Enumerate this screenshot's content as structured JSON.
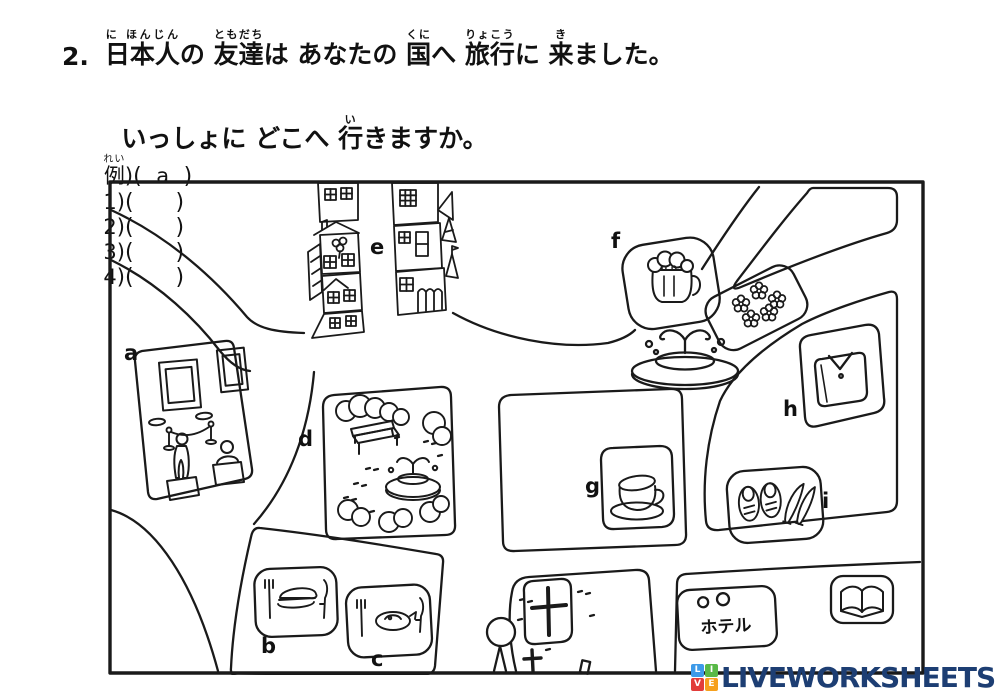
{
  "question": {
    "number": "2.",
    "line1": [
      {
        "b": "日本人",
        "r": "に ほんじん"
      },
      {
        "b": "の "
      },
      {
        "b": "友達",
        "r": "ともだち"
      },
      {
        "b": "は あなたの "
      },
      {
        "b": "国",
        "r": "くに"
      },
      {
        "b": "へ "
      },
      {
        "b": "旅行",
        "r": "りょこう"
      },
      {
        "b": "に "
      },
      {
        "b": "来",
        "r": "き"
      },
      {
        "b": "ました。"
      }
    ],
    "line2": [
      {
        "b": "いっしょに どこへ "
      },
      {
        "b": "行",
        "r": "い"
      },
      {
        "b": "きますか。"
      }
    ]
  },
  "answers": {
    "items": [
      {
        "label": "例",
        "label_ruby": "れい",
        "suffix": ")",
        "open": "(",
        "value": "a",
        "close": ")"
      },
      {
        "label": "1",
        "label_ruby": "",
        "suffix": ")",
        "open": "(",
        "value": "",
        "close": ")"
      },
      {
        "label": "2",
        "label_ruby": "",
        "suffix": ")",
        "open": "(",
        "value": "",
        "close": ")"
      },
      {
        "label": "3",
        "label_ruby": "",
        "suffix": ")",
        "open": "(",
        "value": "",
        "close": ")"
      },
      {
        "label": "4",
        "label_ruby": "",
        "suffix": ")",
        "open": "(",
        "value": "",
        "close": ")"
      }
    ]
  },
  "map": {
    "labels": {
      "a": "a",
      "b": "b",
      "c": "c",
      "d": "d",
      "e": "e",
      "f": "f",
      "g": "g",
      "h": "h",
      "i": "i"
    },
    "hotel_sign": "ホテル",
    "legend": {
      "a": "museum-gallery",
      "b": "restaurant-burger",
      "c": "restaurant-fish",
      "d": "park",
      "e": "town-street",
      "f": "beer-pub",
      "g": "cafe",
      "h": "clothes-shop",
      "i": "shoe-shop",
      "center": "fountain",
      "near_f": "flower-bed",
      "bottom_center": "church",
      "bottom_right_1": "hotel",
      "bottom_right_2": "book-shop"
    },
    "ink_color": "#1a1a1a"
  },
  "logo": {
    "text": "LIVEWORKSHEETS",
    "text_color": "#1d3e73",
    "tiles": [
      {
        "letter": "L",
        "color": "#3d9ae8"
      },
      {
        "letter": "I",
        "color": "#58b947"
      },
      {
        "letter": "V",
        "color": "#e23d3a"
      },
      {
        "letter": "E",
        "color": "#f6a01d"
      }
    ]
  }
}
